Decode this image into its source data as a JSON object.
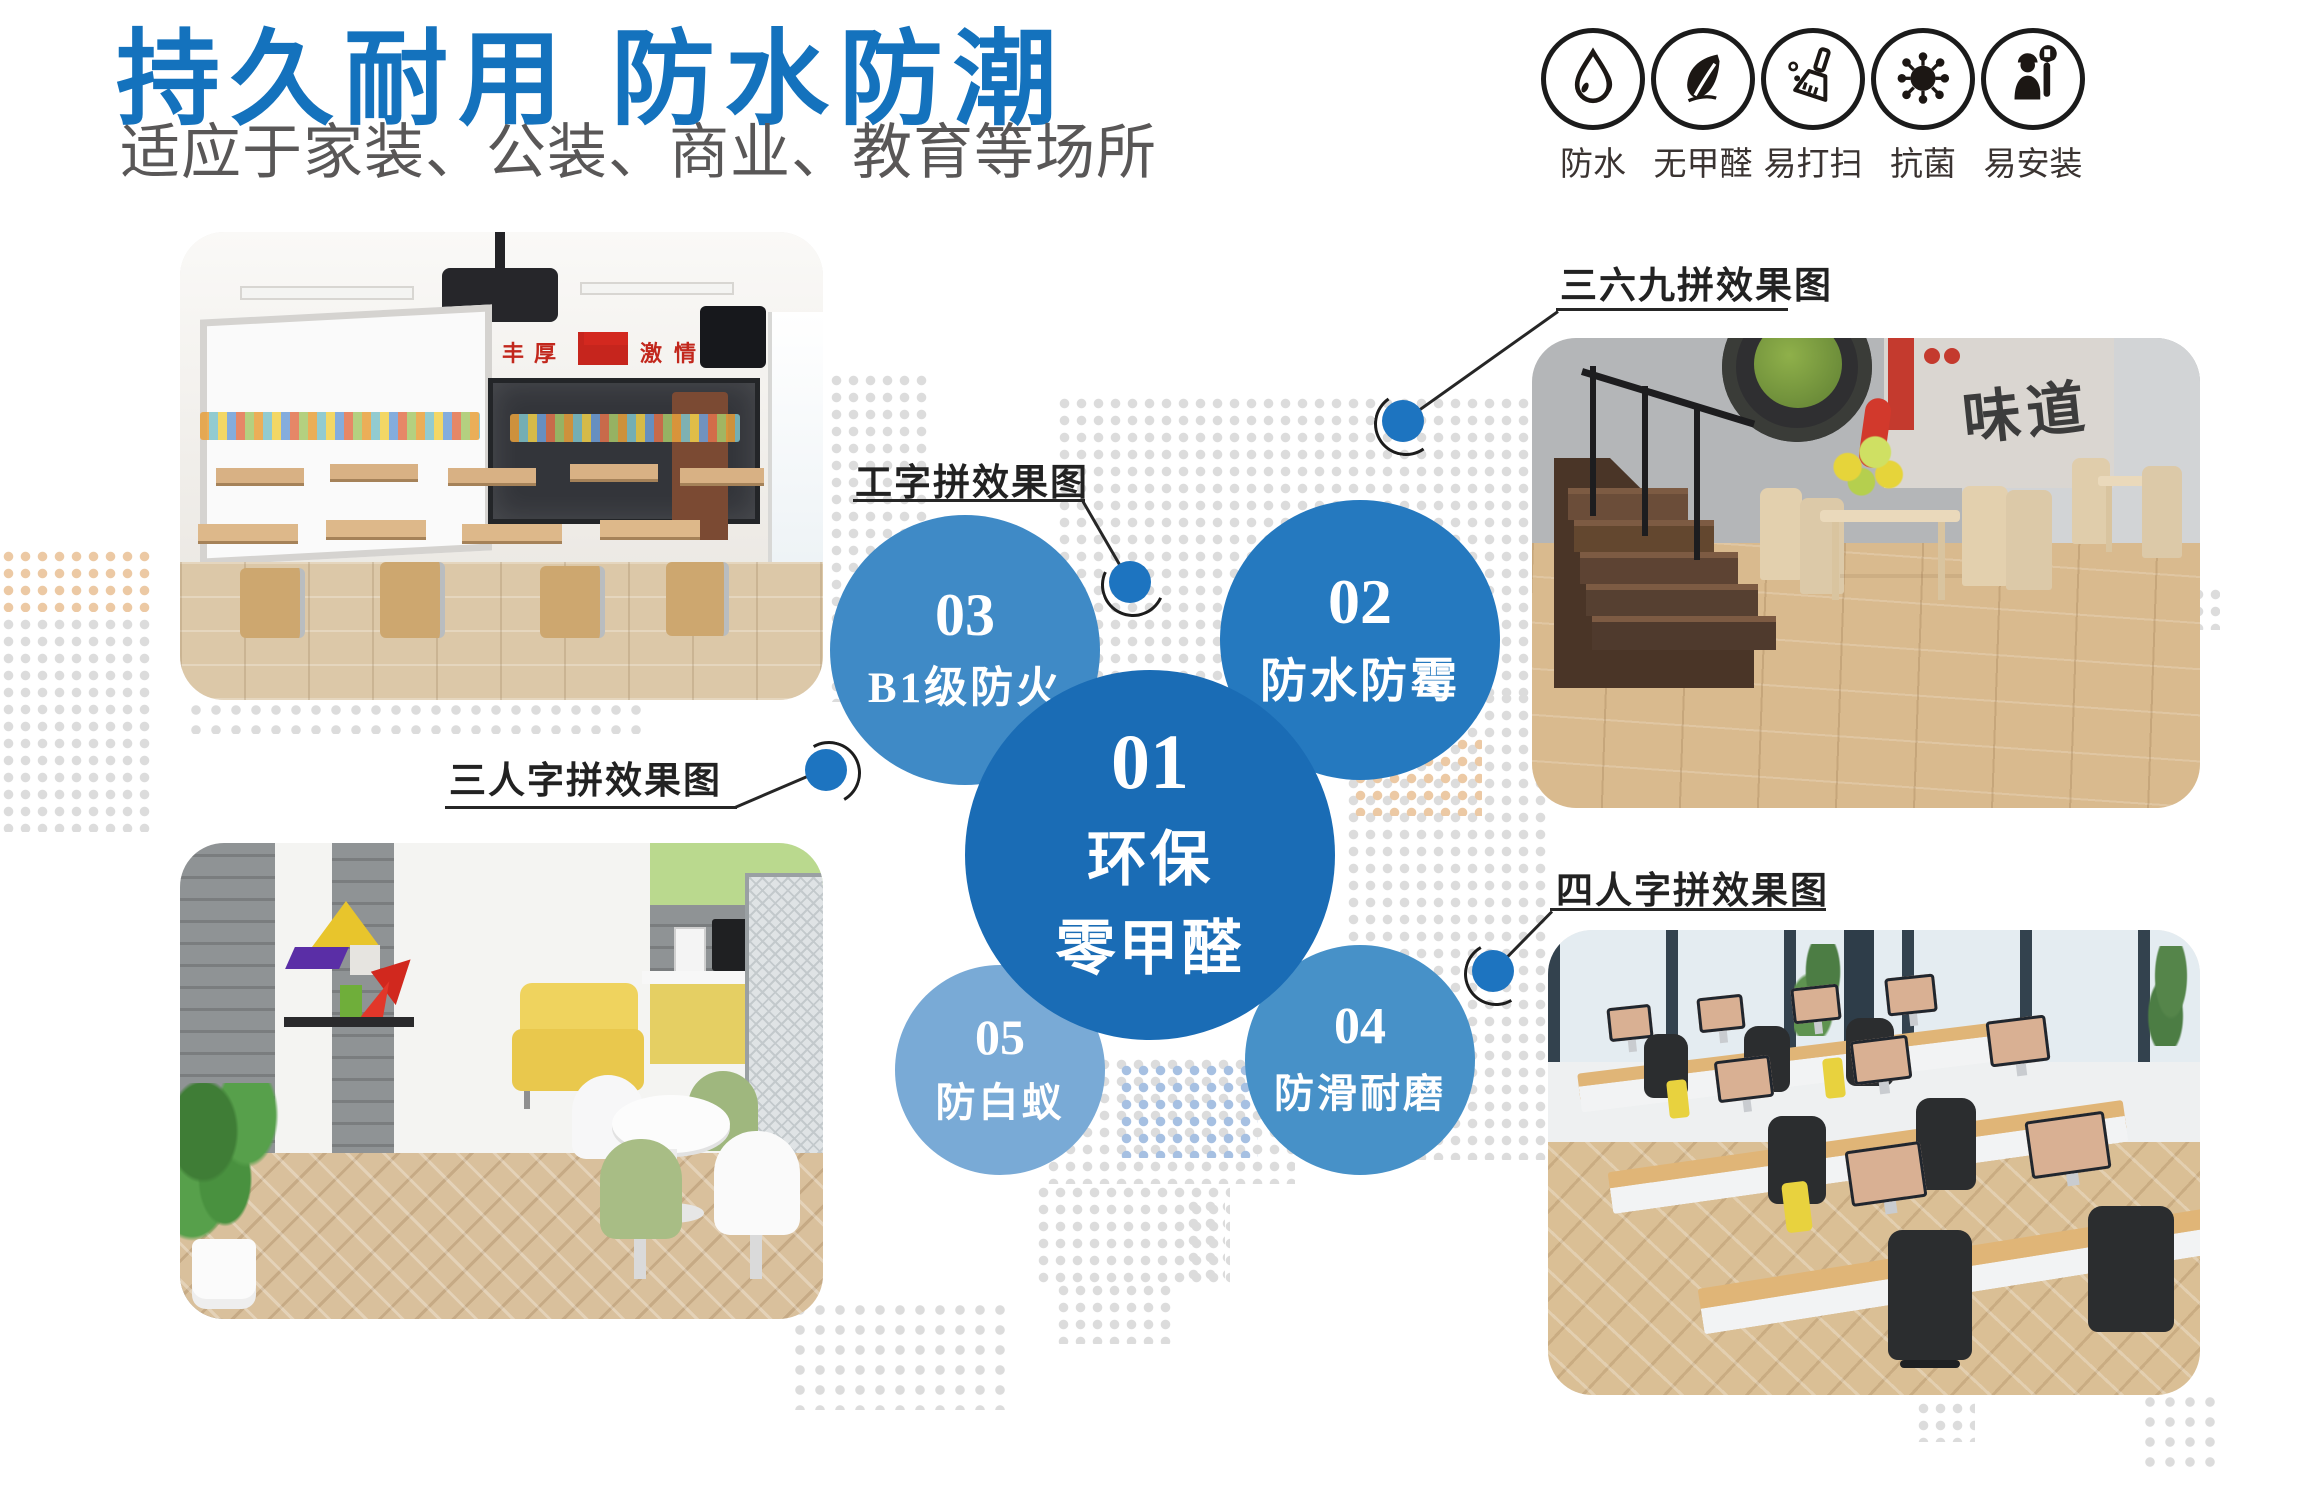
{
  "header": {
    "title": "持久耐用 防水防潮",
    "subtitle": "适应于家装、公装、商业、教育等场所"
  },
  "badges": {
    "items": [
      {
        "icon": "waterdrop-icon",
        "label": "防水"
      },
      {
        "icon": "leaf-icon",
        "label": "无甲醛"
      },
      {
        "icon": "broom-icon",
        "label": "易打扫"
      },
      {
        "icon": "germ-icon",
        "label": "抗菌"
      },
      {
        "icon": "installer-icon",
        "label": "易安装"
      }
    ]
  },
  "bubbles": {
    "center": {
      "number": "01",
      "lines": [
        "环保",
        "零甲醛"
      ],
      "color": "#1a6cb5"
    },
    "items": [
      {
        "number": "02",
        "label": "防水防霉",
        "color": "#2579bf"
      },
      {
        "number": "03",
        "label": "B1级防火",
        "color": "#3f8ac6"
      },
      {
        "number": "04",
        "label": "防滑耐磨",
        "color": "#4791c8"
      },
      {
        "number": "05",
        "label": "防白蚁",
        "color": "#79aad6"
      }
    ]
  },
  "callouts": {
    "i_pattern": {
      "label": "工字拼效果图"
    },
    "pattern_369": {
      "label": "三六九拼效果图"
    },
    "herringbone_3": {
      "label": "三人字拼效果图"
    },
    "herringbone_4": {
      "label": "四人字拼效果图"
    }
  },
  "photos": {
    "classroom": {
      "banner_left": "丰厚",
      "banner_right": "激情灵动"
    },
    "restaurant": {
      "poster_text": "味道"
    }
  },
  "colors": {
    "title_blue": "#1472bd",
    "subtitle_gray": "#595757",
    "callout_dot_blue": "#1d74c0",
    "bubble_dark": "#1a6cb5",
    "bubble_mid": "#2579bf",
    "bubble_light": "#3f8ac6",
    "bubble_lighter": "#4791c8",
    "bubble_lightest": "#79aad6",
    "dot_gray": "#dcdcdc",
    "dot_orange": "#ecc9a4",
    "dot_blue": "#a6c0e2",
    "wood_floor": "#d9bd92"
  }
}
